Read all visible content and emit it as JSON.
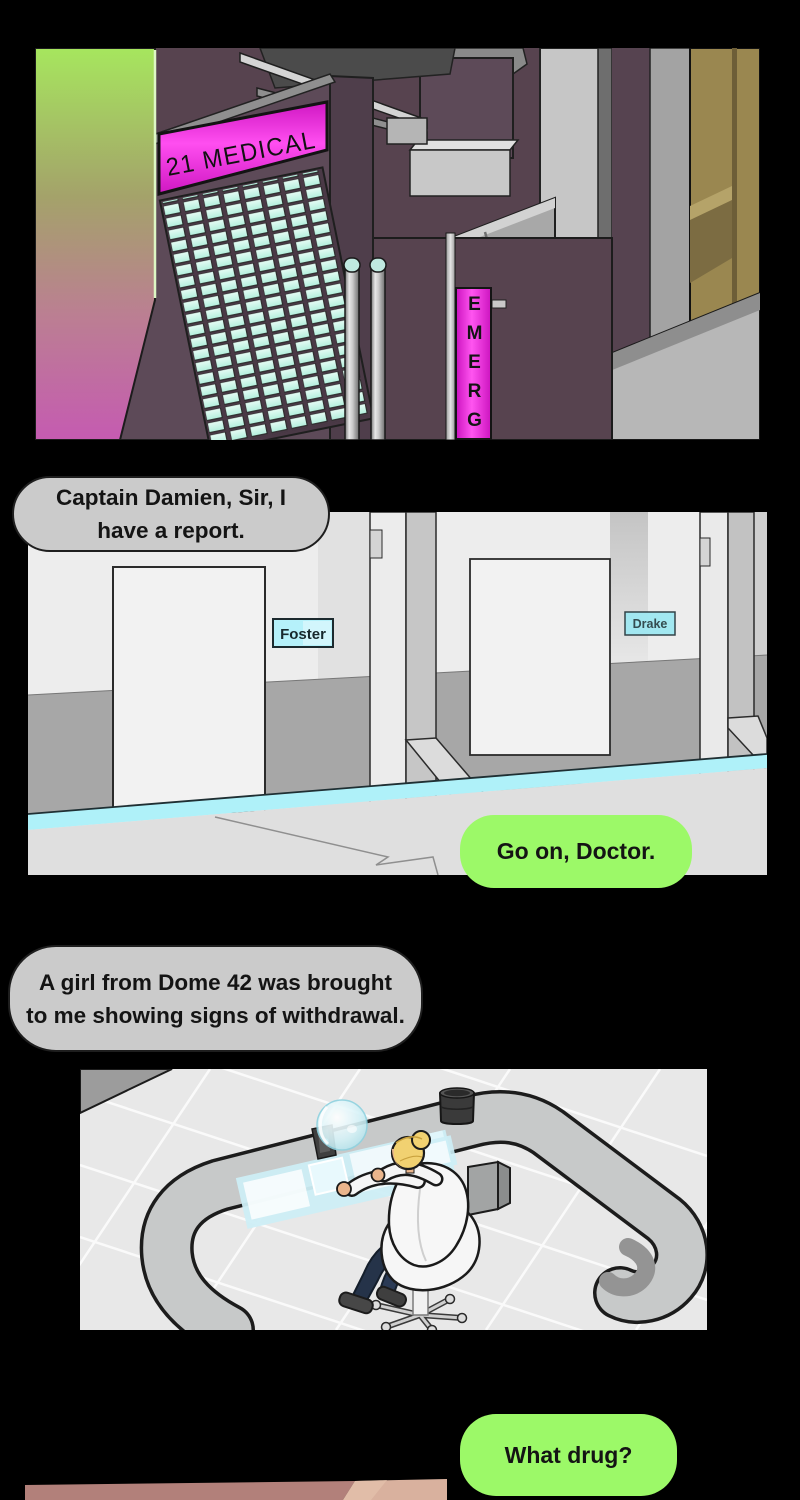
{
  "page": {
    "background": "#000000",
    "kind": "webtoon-comic-page"
  },
  "city_panel": {
    "sign_main": "21 MEDICAL",
    "sign_emergency": "EMERG",
    "colors": {
      "neon_magenta": "#f02be0",
      "building_purple": "#57434f",
      "window_mint": "#c8f4e6",
      "tower_gradient_top": "#a6e65e",
      "tower_gradient_bottom": "#c55bb1",
      "tan_building": "#9a8750"
    }
  },
  "corridor_panel": {
    "door_labels": [
      "Foster",
      "Drake"
    ],
    "colors": {
      "wall": "#ededed",
      "wainscot": "#a7a7a7",
      "floor": "#dfdfdf",
      "floor_strip_cyan": "#aff1f9",
      "label_cyan": "#b5f1fa"
    }
  },
  "office_panel": {
    "colors": {
      "floor": "#e8e8e8",
      "desk_gray": "#c7c9c9",
      "hologram_cyan": "#cdeef6",
      "coat_white": "#f7f7f7",
      "hair_blonde": "#f1d171",
      "pants_navy": "#253349"
    }
  },
  "closeup_panel": {
    "colors": {
      "skin_dark": "#b2807a",
      "skin_light": "#d9b19e"
    }
  },
  "bubbles": {
    "report": {
      "lines": [
        "Captain Damien, Sir, I",
        "have a report."
      ],
      "color": "#cbcbcb"
    },
    "go_on": {
      "text": "Go on, Doctor.",
      "color": "#9cf968"
    },
    "girl": {
      "lines": [
        "A girl from Dome 42 was brought",
        "to me showing signs of withdrawal."
      ],
      "color": "#cbcbcb"
    },
    "what_drug": {
      "text": "What drug?",
      "color": "#9cf968"
    }
  }
}
